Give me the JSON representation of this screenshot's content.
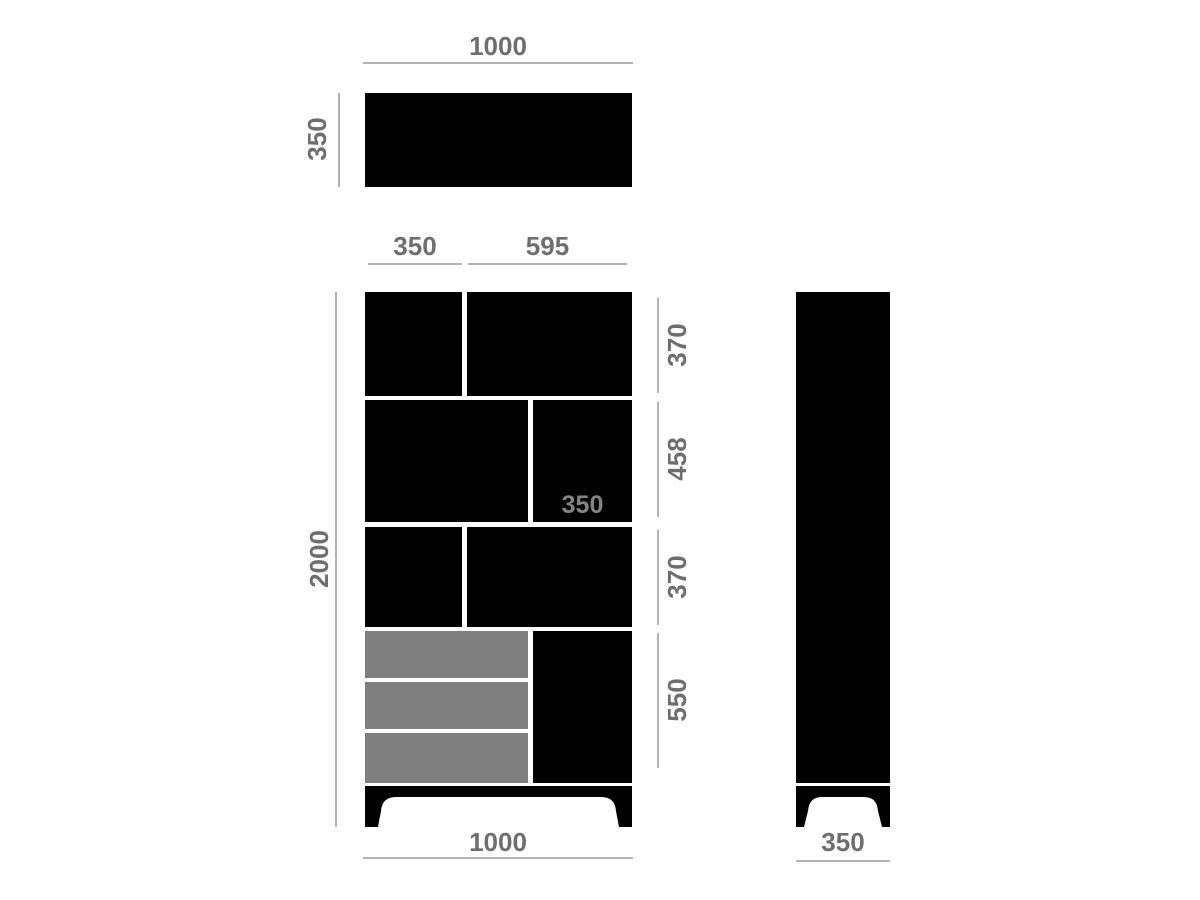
{
  "colors": {
    "panel_black": "#000000",
    "drawer_gray": "#7f7f7f",
    "dim_line_gray": "#b3b3b3",
    "dim_text_gray": "#6e6e6e",
    "inner_label_gray": "#848484",
    "background": "#ffffff"
  },
  "views": {
    "top": {
      "width_dim": "1000",
      "depth_dim": "350"
    },
    "front": {
      "left_column_width_dim": "350",
      "right_column_width_dim": "595",
      "overall_height_dim": "2000",
      "row_height_dims": [
        "370",
        "458",
        "370",
        "550"
      ],
      "middle_right_depth_dim": "350",
      "overall_width_dim": "1000"
    },
    "side": {
      "depth_dim": "350"
    }
  }
}
